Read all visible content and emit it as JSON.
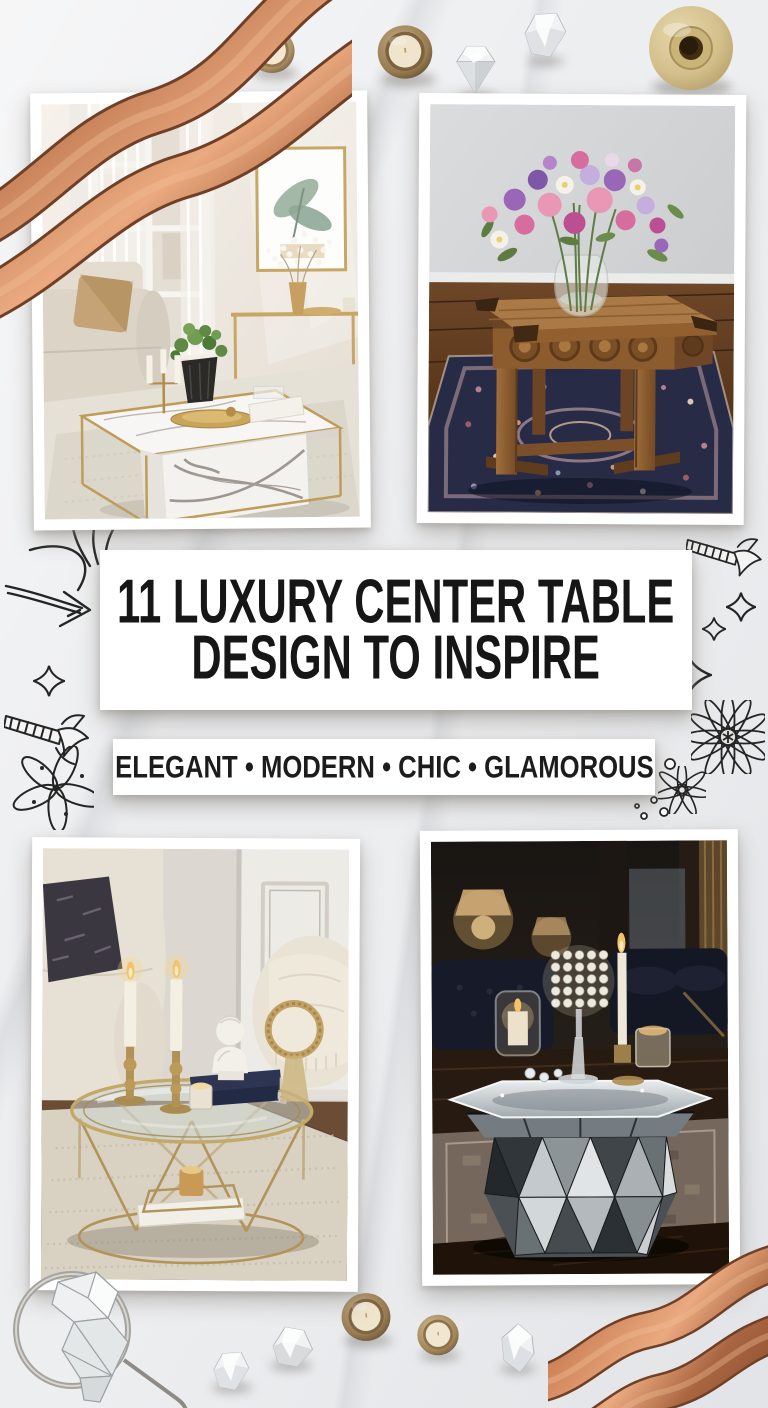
{
  "poster": {
    "width": 768,
    "height": 1408,
    "background": {
      "base_color": "#edeef0",
      "marble_vein_color": "#c9ccd1"
    }
  },
  "title_card": {
    "line1": "11 LUXURY CENTER TABLE",
    "line2": "DESIGN TO INSPIRE",
    "text_color": "#161616",
    "card_color": "#ffffff"
  },
  "subtitle_card": {
    "text": "ELEGANT • MODERN • CHIC • GLAMOROUS",
    "text_color": "#1c1c1c",
    "card_color": "#ffffff"
  },
  "photos": [
    {
      "label": "white-marble-and-gold-coffee-table-in-bright-living-room"
    },
    {
      "label": "carved-rustic-wood-table-with-flower-bouquet-on-oriental-rug"
    },
    {
      "label": "round-gold-glass-top-table-with-candlesticks-and-bust"
    },
    {
      "label": "mirrored-faceted-drum-table-with-crystal-candle-holders"
    }
  ],
  "decor": {
    "ink_color": "#242424",
    "copper_color": "#bc7a54",
    "gold_color": "#cdb68a",
    "icons": [
      "copper-ribbon",
      "tealight-candle",
      "crystal-diamond",
      "gold-spool",
      "silver-ring-with-crystals",
      "sketch-arrow",
      "sparkle",
      "daisy",
      "flower",
      "burst"
    ]
  }
}
